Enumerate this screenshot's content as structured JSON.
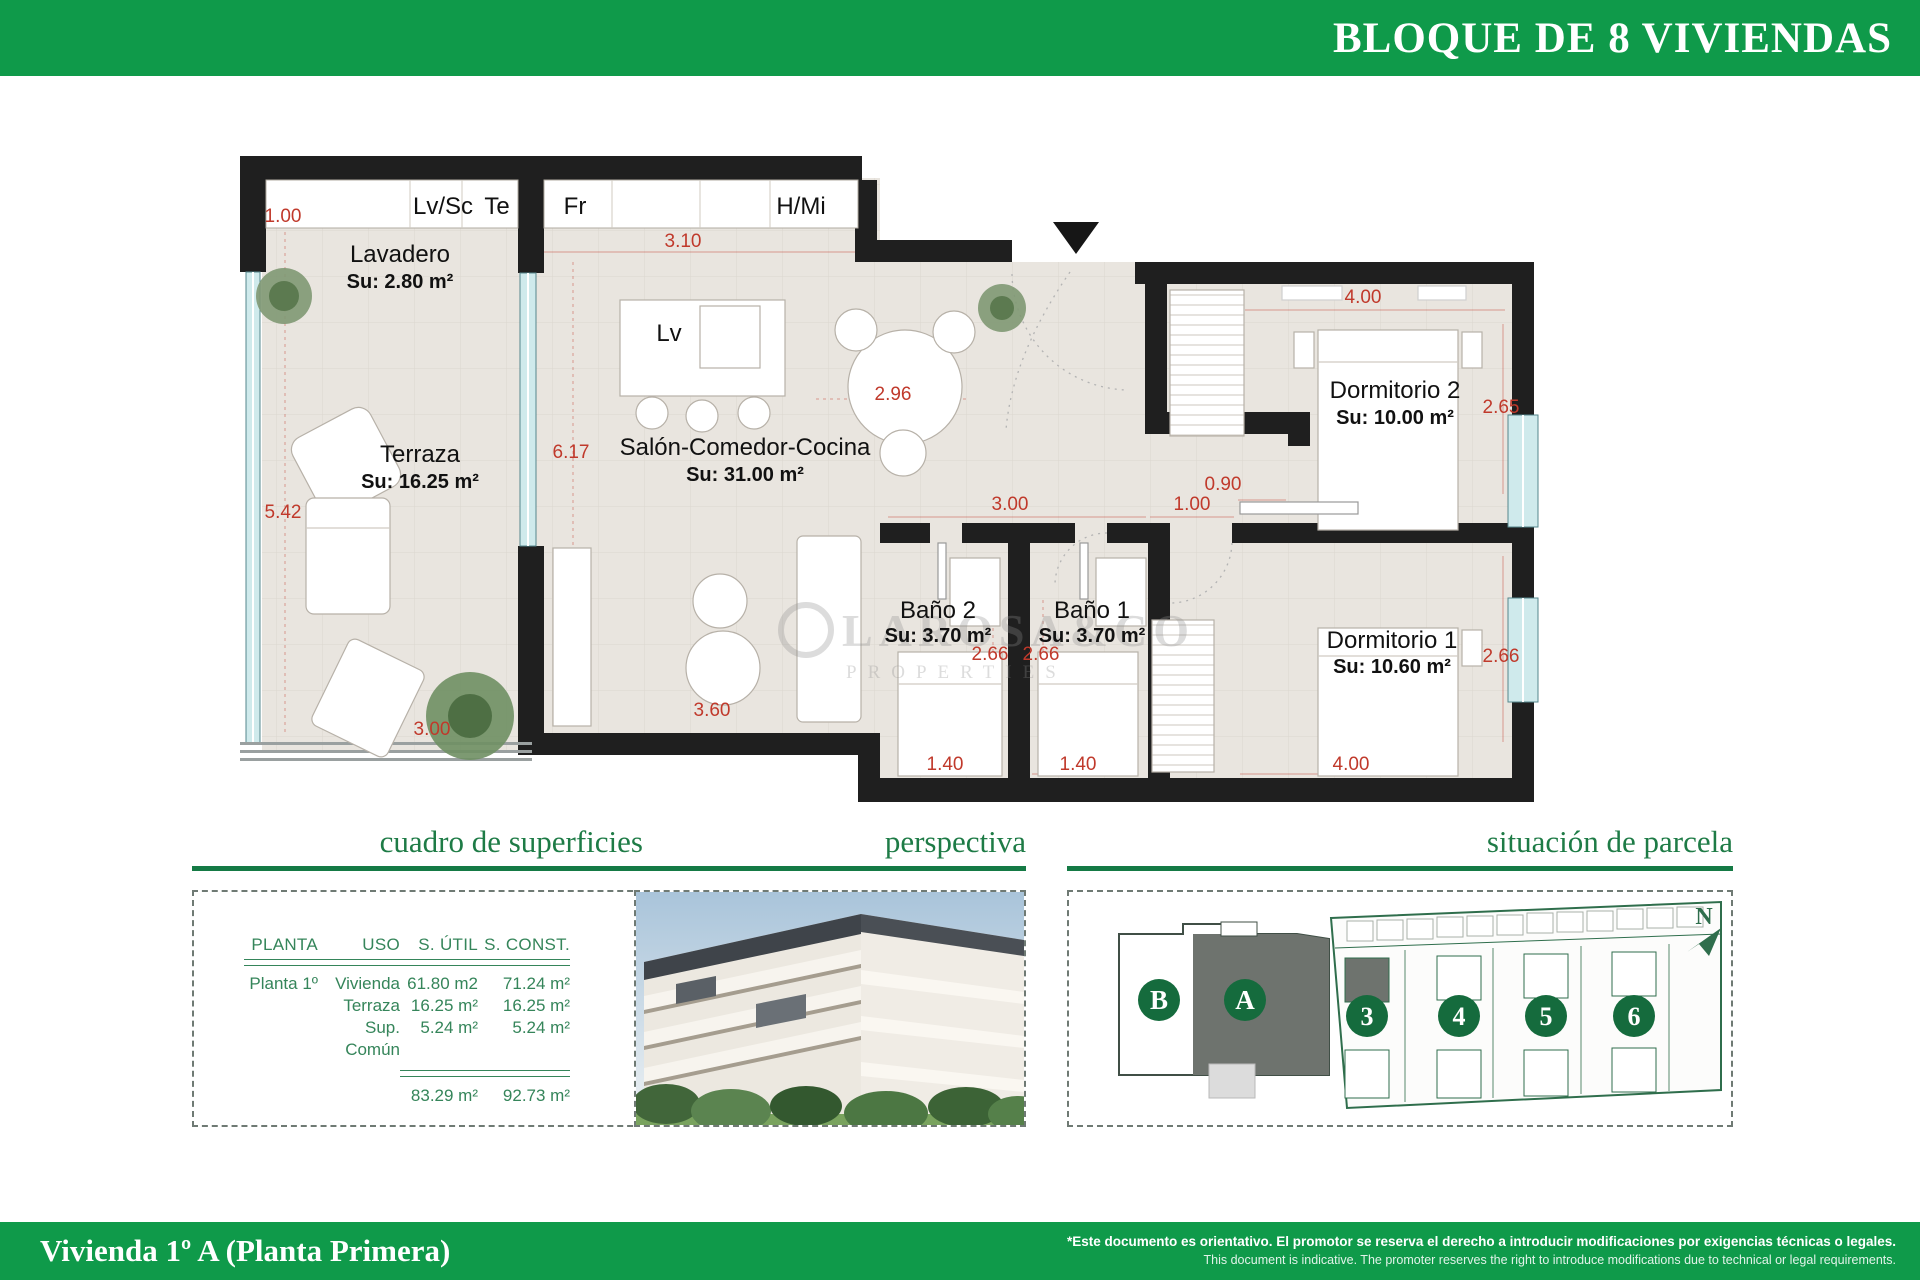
{
  "colors": {
    "brand_green": "#0f9a4a",
    "heading_green": "#1e7b46",
    "table_green": "#35855a",
    "dim_red": "#c0392b"
  },
  "header": {
    "title": "BLOQUE DE 8 VIVIENDAS"
  },
  "footer": {
    "title": "Vivienda 1º A (Planta Primera)",
    "disclaimer_es": "*Este documento es orientativo. El promotor se reserva el derecho a introducir modificaciones por exigencias técnicas o legales.",
    "disclaimer_en": "This document is indicative. The promoter reserves the right to introduce modifications due to technical or legal requirements."
  },
  "floorplan": {
    "watermark_line1": "LAROSA&CO",
    "watermark_line2": "PROPERTIES",
    "rooms": [
      {
        "name": "Lavadero",
        "area": "Su: 2.80 m²"
      },
      {
        "name": "Terraza",
        "area": "Su: 16.25 m²"
      },
      {
        "name": "Salón-Comedor-Cocina",
        "area": "Su: 31.00 m²"
      },
      {
        "name": "Baño 2",
        "area": "Su: 3.70 m²"
      },
      {
        "name": "Baño 1",
        "area": "Su: 3.70 m²"
      },
      {
        "name": "Dormitorio 2",
        "area": "Su: 10.00 m²"
      },
      {
        "name": "Dormitorio 1",
        "area": "Su: 10.60 m²"
      }
    ],
    "fixtures": [
      "Lv/Sc",
      "Te",
      "Fr",
      "H/Mi",
      "Lv"
    ],
    "dimensions": [
      "1.00",
      "3.10",
      "2.96",
      "6.17",
      "5.42",
      "3.00",
      "3.60",
      "3.00",
      "1.00",
      "0.90",
      "4.00",
      "2.65",
      "2.66",
      "2.66",
      "2.66",
      "1.40",
      "1.40",
      "4.00"
    ]
  },
  "sections": {
    "superficies": {
      "heading": "cuadro de superficies",
      "table": {
        "headers": [
          "PLANTA",
          "USO",
          "S. ÚTIL",
          "S. CONST."
        ],
        "rows": [
          [
            "Planta 1º",
            "Vivienda",
            "61.80 m2",
            "71.24 m²"
          ],
          [
            "",
            "Terraza",
            "16.25 m²",
            "16.25 m²"
          ],
          [
            "",
            "Sup. Común",
            "5.24 m²",
            "5.24 m²"
          ]
        ],
        "total_util": "83.29 m²",
        "total_const": "92.73 m²"
      }
    },
    "perspectiva": {
      "heading": "perspectiva"
    },
    "parcela": {
      "heading": "situación de parcela",
      "compass": "N",
      "block_b": "B",
      "block_a": "A",
      "plots": [
        "3",
        "4",
        "5",
        "6"
      ]
    }
  }
}
